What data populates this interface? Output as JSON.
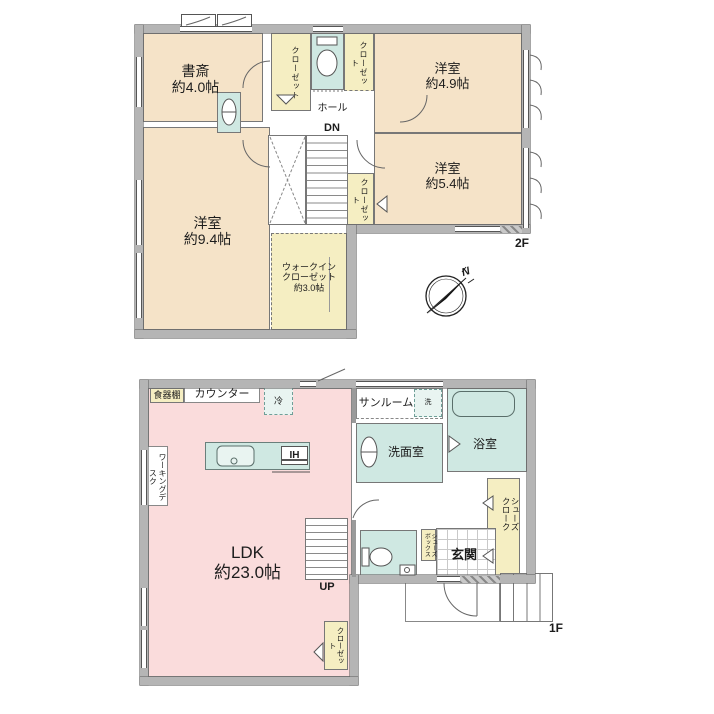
{
  "floor2": {
    "floor_label": "2F",
    "study": {
      "name": "書斎",
      "area": "約4.0帖"
    },
    "room49": {
      "name": "洋室",
      "area": "約4.9帖"
    },
    "room54": {
      "name": "洋室",
      "area": "約5.4帖"
    },
    "room94": {
      "name": "洋室",
      "area": "約9.4帖"
    },
    "wic": {
      "line1": "ウォークイン",
      "line2": "クローゼット",
      "line3": "約3.0帖"
    },
    "hall": "ホール",
    "dn": "DN",
    "closet_a": "クローゼット",
    "closet_b": "クローゼット",
    "closet_c": "クローゼット"
  },
  "floor1": {
    "floor_label": "1F",
    "ldk": {
      "name": "LDK",
      "area": "約23.0帖"
    },
    "sunroom": "サンルーム",
    "washroom": "洗面室",
    "bathroom": "浴室",
    "entrance": "玄関",
    "dish_shelf": "食器棚",
    "counter": "カウンター",
    "fridge": "冷",
    "washer": "洗",
    "ih_cooktop": "IH",
    "working_desk": "ワーキングデスク",
    "shoes_cloak": "シューズクローク",
    "shoes_box": "シューズボックス",
    "closet": "クローゼット",
    "up": "UP"
  },
  "compass": {
    "north_label": "N"
  },
  "colors": {
    "room_beige": "#f5e3c8",
    "closet_yellow": "#f5eec2",
    "wet_cyan": "#cfe8e2",
    "ldk_pink": "#fadcdc",
    "wall_gray": "#b5b5b5"
  }
}
